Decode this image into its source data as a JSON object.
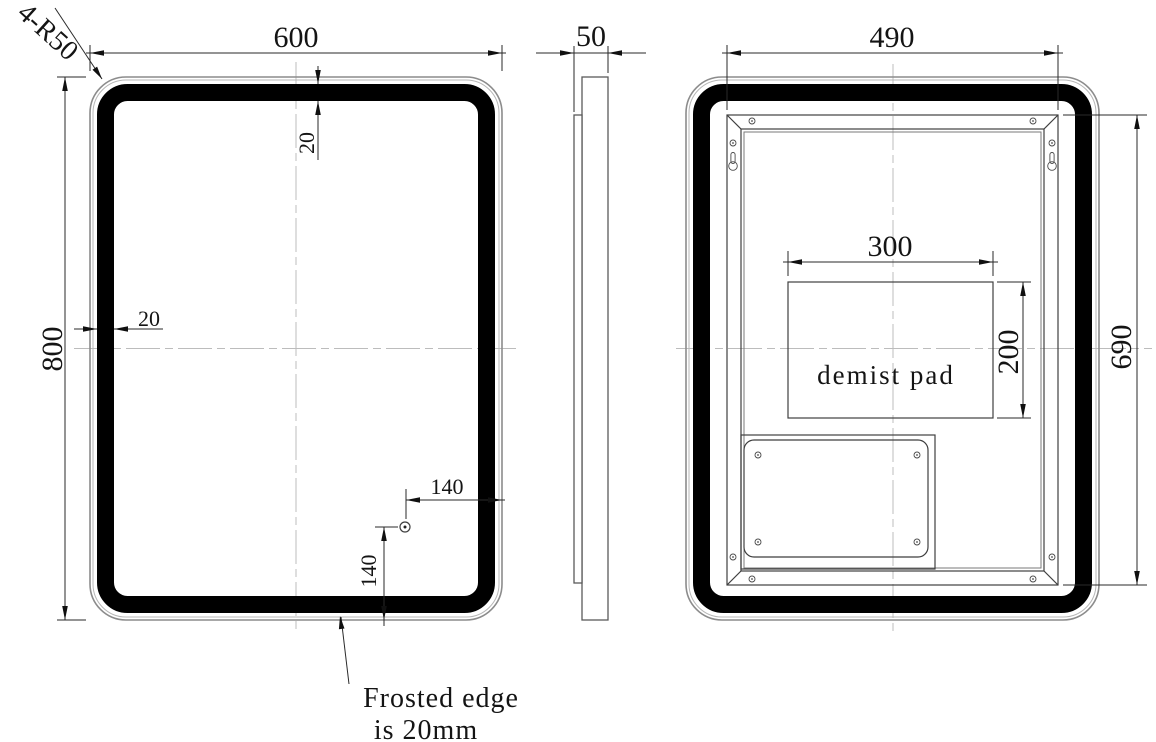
{
  "front_view": {
    "width_dim": "600",
    "height_dim": "800",
    "frosted_edge_top_dim": "20",
    "frosted_edge_left_dim": "20",
    "sensor_offset_right_dim": "140",
    "sensor_offset_bottom_dim": "140",
    "corner_radius_note": "4-R50",
    "frosted_note_line1": "Frosted edge",
    "frosted_note_line2": "is 20mm"
  },
  "side_view": {
    "depth_dim": "50"
  },
  "back_view": {
    "back_box_width_dim": "490",
    "back_box_height_dim": "690",
    "demist_pad_width_dim": "300",
    "demist_pad_height_dim": "200",
    "demist_pad_label": "demist pad"
  },
  "colors": {
    "background": "#ffffff",
    "object_line": "#3f3f3f",
    "glass_edge": "#8c8c8c",
    "frosted_band": "#000000",
    "centerline": "#bcbcbc",
    "dimension_line": "#2a2a2a",
    "text": "#141414"
  }
}
